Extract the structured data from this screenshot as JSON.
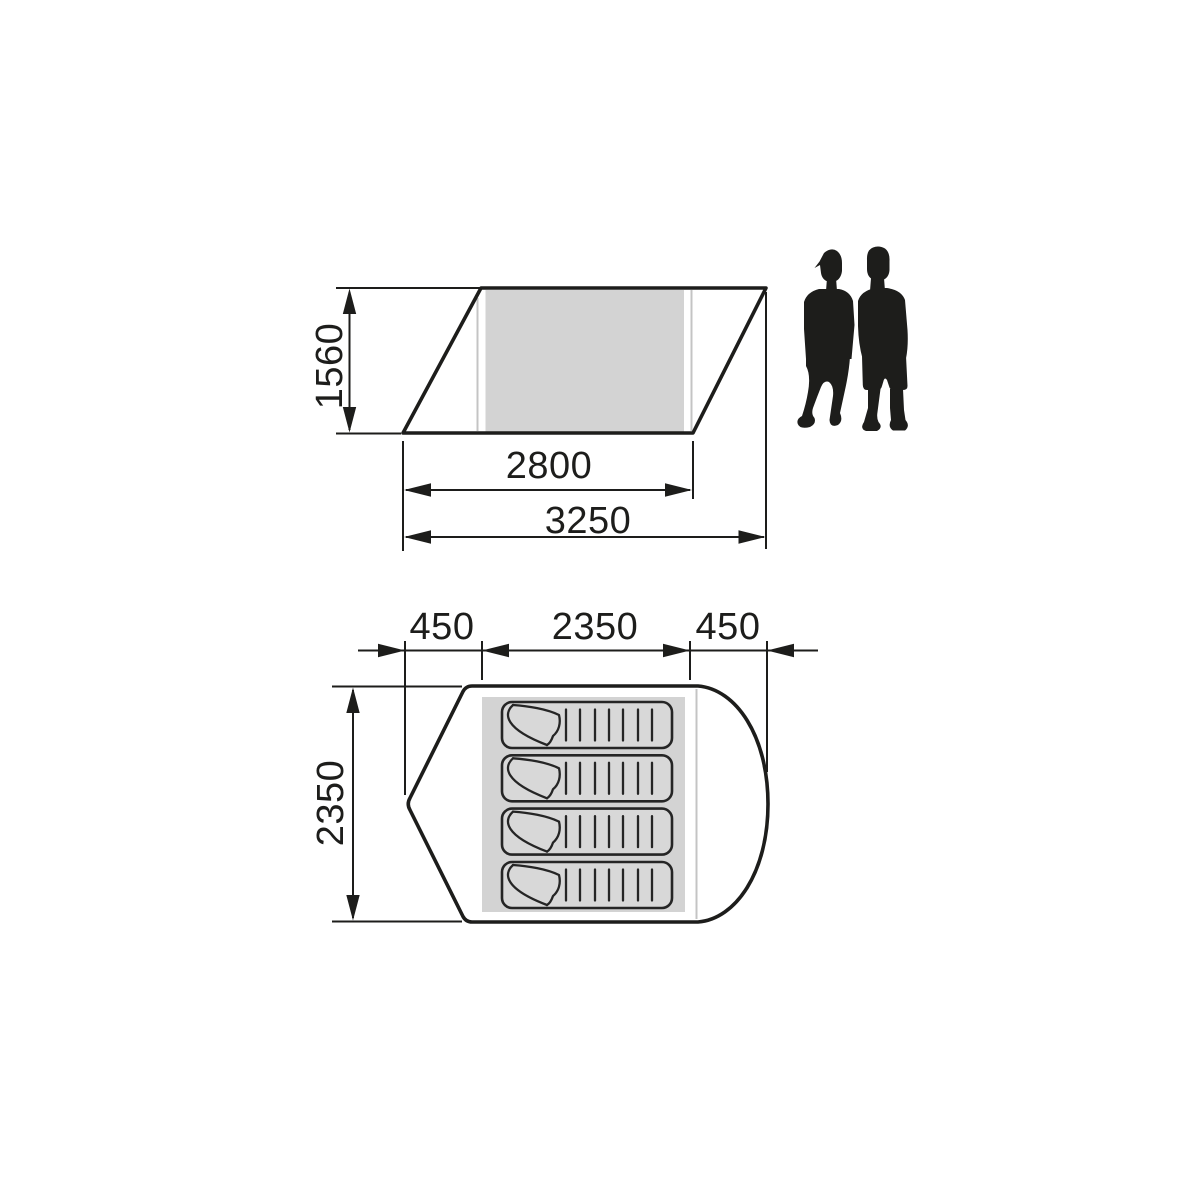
{
  "side_view": {
    "height_label": "1560",
    "inner_width_label": "2800",
    "total_width_label": "3250"
  },
  "floor_plan": {
    "left_porch_label": "450",
    "inner_width_label": "2350",
    "right_porch_label": "450",
    "depth_label": "2350",
    "sleeping_mat_count": 4
  },
  "scale_figures": {
    "count": 2
  },
  "colors": {
    "line": "#1d1d1b",
    "inner_area_fill": "#d3d3d3",
    "mat_fill": "#d8d8d8",
    "faint_line": "#c4c4c4",
    "background": "#ffffff"
  }
}
